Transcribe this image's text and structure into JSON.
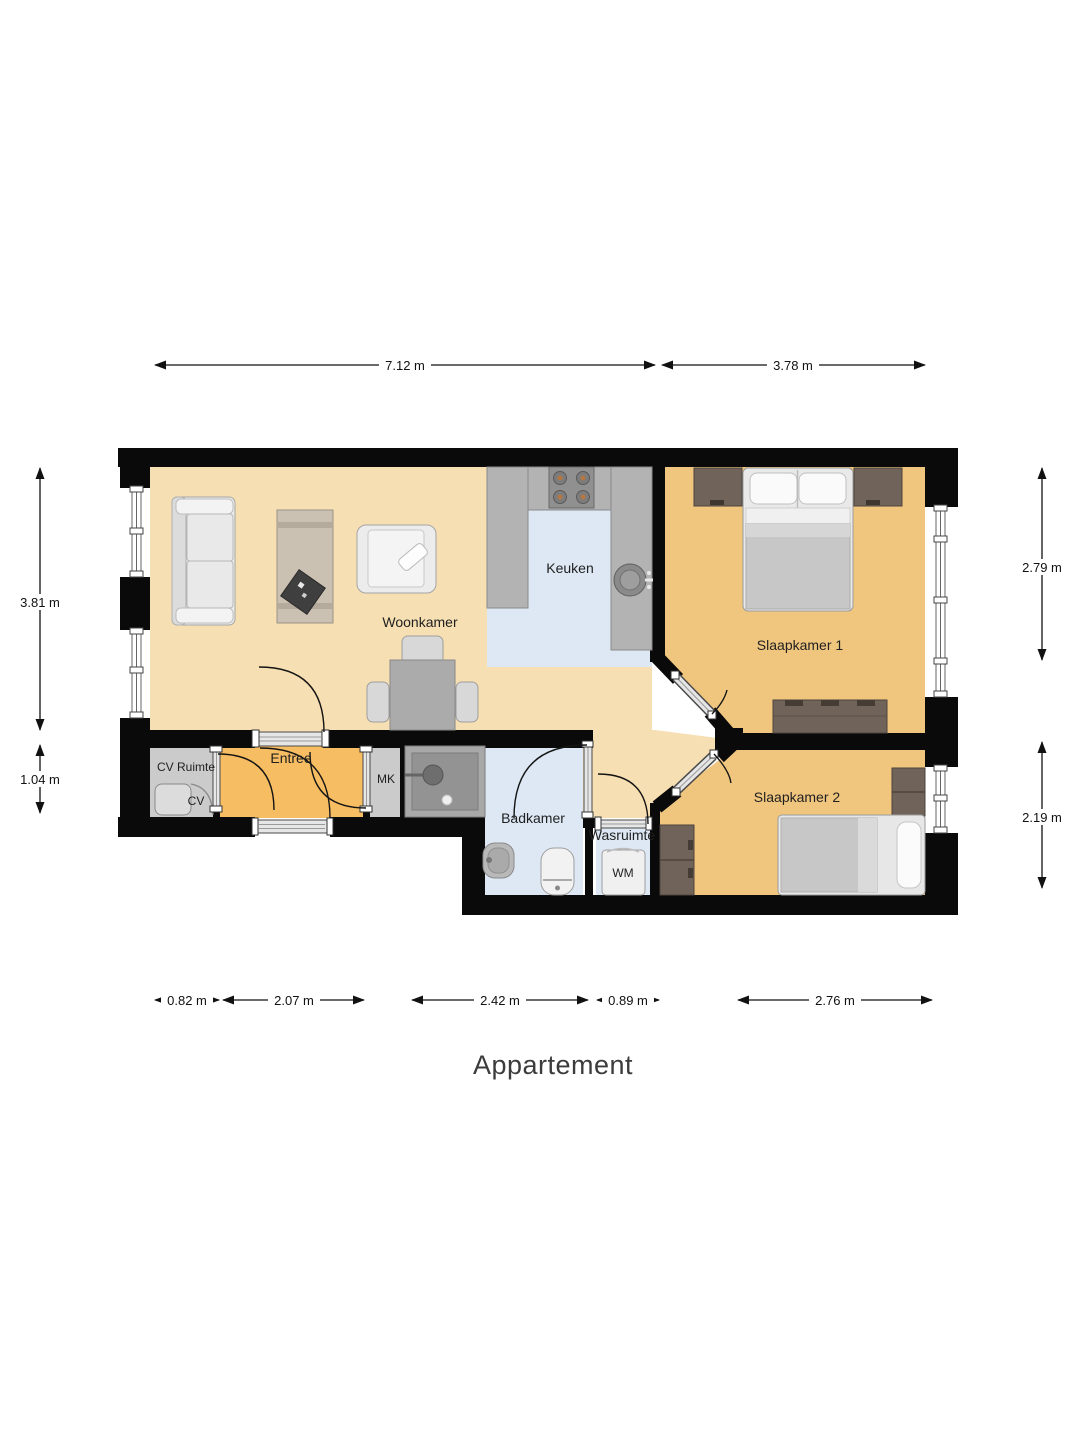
{
  "title": "Appartement",
  "rooms": {
    "woonkamer": "Woonkamer",
    "keuken": "Keuken",
    "slaapkamer1": "Slaapkamer 1",
    "slaapkamer2": "Slaapkamer 2",
    "entree": "Entree",
    "cv_ruimte": "CV Ruimte",
    "cv": "CV",
    "mk": "MK",
    "badkamer": "Badkamer",
    "wasruimte": "Wasruimte",
    "wm": "WM"
  },
  "dimensions": {
    "top": [
      "7.12 m",
      "3.78 m"
    ],
    "left": [
      "3.81 m",
      "1.04 m"
    ],
    "right": [
      "2.79 m",
      "2.19 m"
    ],
    "bottom": [
      "0.82 m",
      "2.07 m",
      "2.42 m",
      "0.89 m",
      "2.76 m"
    ]
  },
  "colors": {
    "wall": "#0a0a0a",
    "living_floor": "#f6dfb2",
    "bedroom_floor": "#f0c67f",
    "entree_floor": "#f6bd62",
    "wet_floor": "#dde8f4",
    "utility_floor": "#cbcbcb"
  }
}
